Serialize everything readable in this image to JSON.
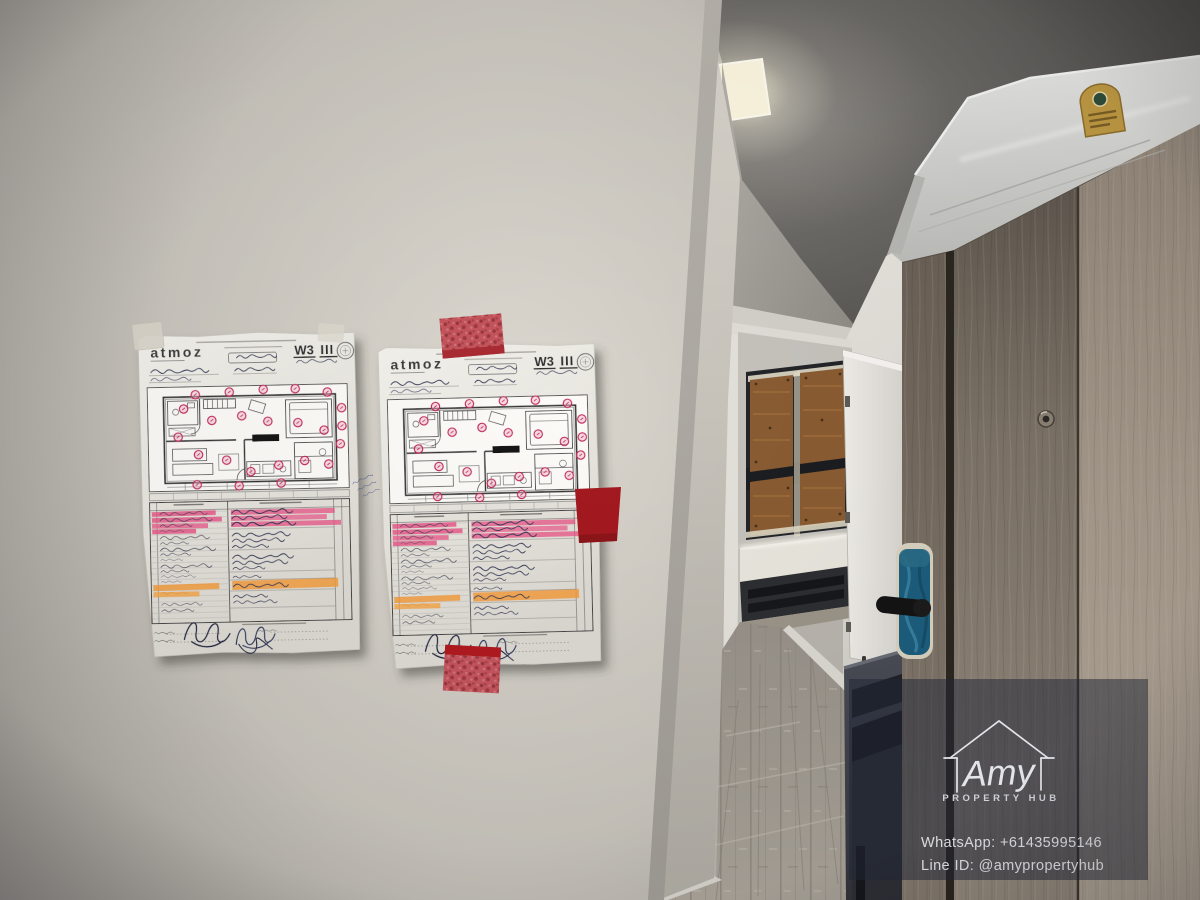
{
  "watermark": {
    "brand": "Amy",
    "tagline": "PROPERTY HUB",
    "whatsapp": "WhatsApp: +61435995146",
    "line_id": "Line ID: @amypropertyhub"
  },
  "documents": {
    "brand_logo": "atmoz",
    "sheet_code": "W3",
    "sheet_tally": "III"
  },
  "palette": {
    "wall": "#cfccc4",
    "ceiling_dark": "#4d4b48",
    "floor_plank": "#a39d94",
    "entry_door_wood": "#8d8276",
    "wardrobe_wood": "#b2a698",
    "lock_film_blue": "#1d5d7d",
    "tape_red": "#c4545c",
    "marker_red": "#a3191f",
    "highlight_pink": "#e84e83",
    "highlight_orange": "#f49b38",
    "paper_white": "#efeee8",
    "watermark_overlay": "#222837"
  }
}
